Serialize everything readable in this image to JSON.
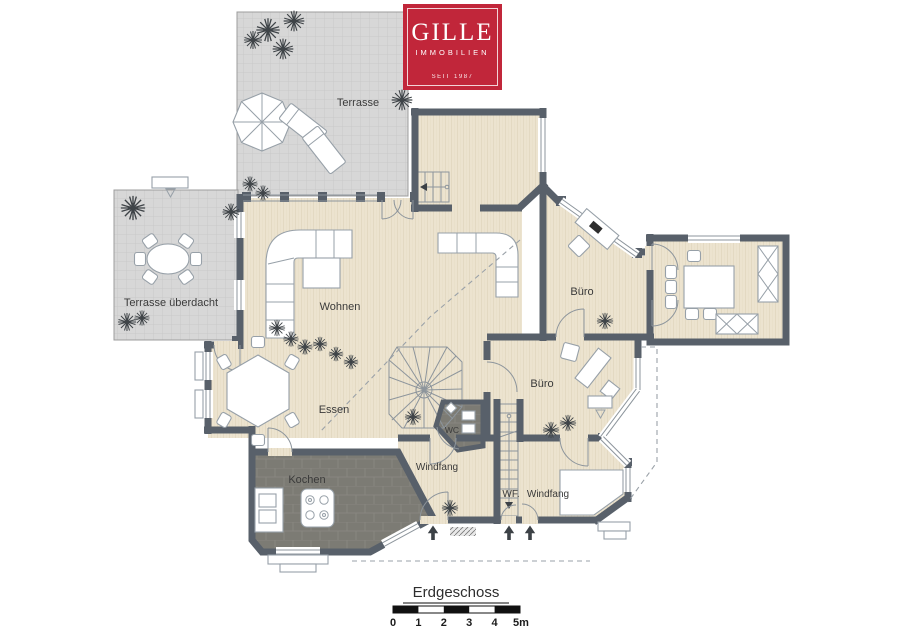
{
  "logo": {
    "brand": "GILLE",
    "division": "IMMOBILIEN",
    "since": "SEIT 1987"
  },
  "floorplan": {
    "title": "Erdgeschoss",
    "rooms": {
      "terrasse": "Terrasse",
      "terrasse_ueberdacht": "Terrasse überdacht",
      "wohnen": "Wohnen",
      "buero_top": "Büro",
      "buero_mid": "Büro",
      "essen": "Essen",
      "kochen": "Kochen",
      "wc": "WC",
      "windfang_left": "Windfang",
      "wf": "WF.",
      "windfang_right": "Windfang"
    },
    "scale_bar": {
      "meters": 5,
      "ticks": [
        "0",
        "1",
        "2",
        "3",
        "4",
        "5m"
      ]
    }
  },
  "colors": {
    "wall": "#58606A",
    "floor": "#ECE3CF",
    "terrace": "#D7D7D7",
    "tile": "#7C7B74",
    "logo_red": "#C1263A"
  }
}
